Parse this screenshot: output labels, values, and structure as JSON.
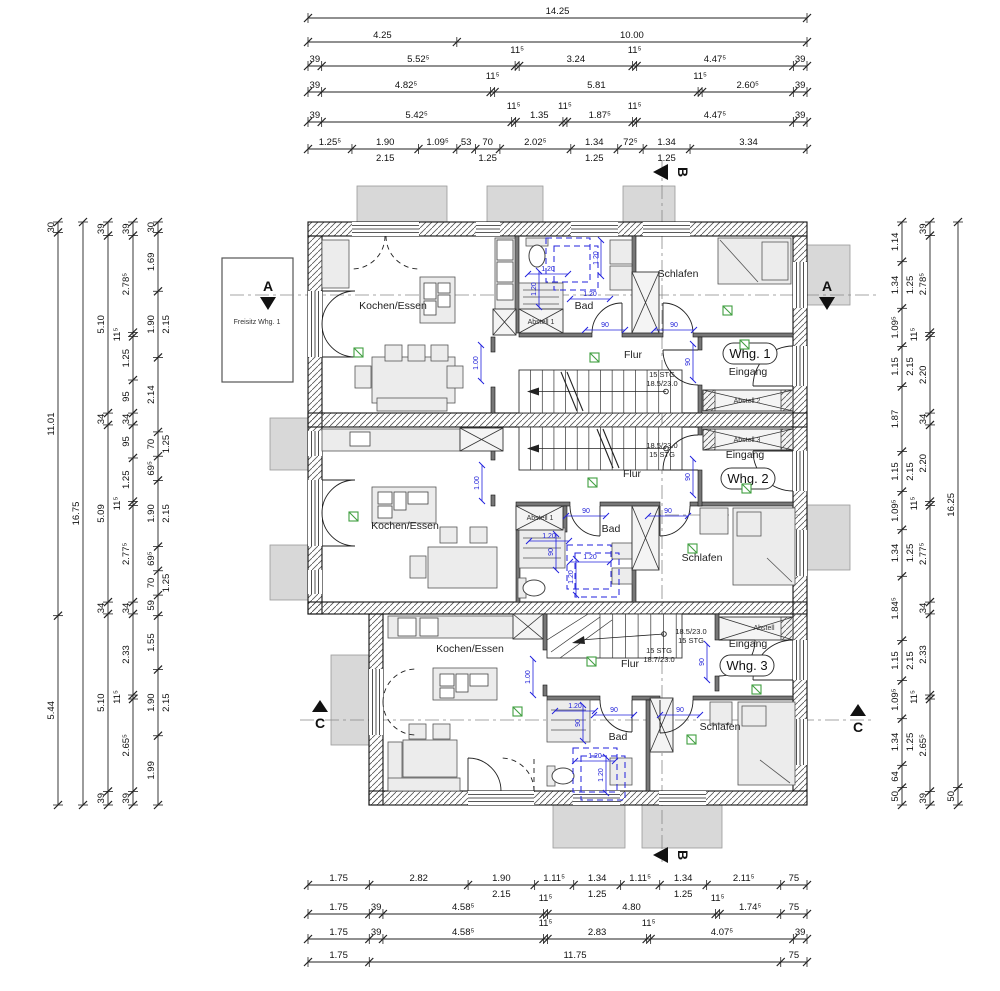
{
  "colors": {
    "line": "#1a1a1a",
    "wall_hatch": "#444444",
    "grey_fill": "#d8d8d8",
    "furniture_fill": "#ececec",
    "sanitary_blue": "#2020dd",
    "detector_green": "#3f9e3f",
    "axis_grey": "#888888"
  },
  "dimensions": {
    "top": [
      {
        "y": 18,
        "segments": [
          [
            14.25,
            "14.25"
          ]
        ]
      },
      {
        "y": 42,
        "segments": [
          [
            4.25,
            "4.25"
          ],
          [
            10.0,
            "10.00"
          ]
        ]
      },
      {
        "y": 66,
        "segments": [
          [
            0.39,
            "39"
          ],
          [
            5.525,
            "5.52⁵"
          ],
          [
            0.115,
            "11⁵"
          ],
          [
            3.24,
            "3.24"
          ],
          [
            0.115,
            "11⁵"
          ],
          [
            4.475,
            "4.47⁵"
          ],
          [
            0.39,
            "39"
          ]
        ]
      },
      {
        "y": 92,
        "segments": [
          [
            0.39,
            "39"
          ],
          [
            4.825,
            "4.82⁵"
          ],
          [
            0.115,
            "11⁵"
          ],
          [
            5.81,
            "5.81"
          ],
          [
            0.115,
            "11⁵"
          ],
          [
            2.605,
            "2.60⁵"
          ],
          [
            0.39,
            "39"
          ]
        ]
      },
      {
        "y": 122,
        "segments": [
          [
            0.39,
            "39"
          ],
          [
            5.425,
            "5.42⁵"
          ],
          [
            0.115,
            "11⁵"
          ],
          [
            1.35,
            "1.35"
          ],
          [
            0.115,
            "11⁵"
          ],
          [
            1.875,
            "1.87⁵"
          ],
          [
            0.115,
            "11⁵"
          ],
          [
            4.475,
            "4.47⁵"
          ],
          [
            0.39,
            "39"
          ]
        ]
      },
      {
        "y": 149,
        "segments": [
          [
            1.255,
            "1.25⁵"
          ],
          [
            1.9,
            "1.90",
            "2.15"
          ],
          [
            1.095,
            "1.09⁵"
          ],
          [
            0.53,
            "53"
          ],
          [
            0.7,
            "70",
            "1.25"
          ],
          [
            2.025,
            "2.02⁵"
          ],
          [
            1.34,
            "1.34",
            "1.25"
          ],
          [
            0.725,
            "72⁵"
          ],
          [
            1.34,
            "1.34",
            "1.25"
          ],
          [
            3.34,
            "3.34"
          ]
        ]
      }
    ],
    "bottom": [
      {
        "y": 885,
        "segments": [
          [
            1.75,
            "1.75"
          ],
          [
            2.82,
            "2.82"
          ],
          [
            1.9,
            "1.90",
            "2.15"
          ],
          [
            1.115,
            "1.11⁵"
          ],
          [
            1.34,
            "1.34",
            "1.25"
          ],
          [
            1.115,
            "1.11⁵"
          ],
          [
            1.34,
            "1.34",
            "1.25"
          ],
          [
            2.115,
            "2.11⁵"
          ],
          [
            0.75,
            "75"
          ]
        ]
      },
      {
        "y": 914,
        "segments": [
          [
            1.75,
            "1.75"
          ],
          [
            0.39,
            "39"
          ],
          [
            4.585,
            "4.58⁵"
          ],
          [
            0.115,
            "11⁵"
          ],
          [
            4.8,
            "4.80"
          ],
          [
            0.115,
            "11⁵"
          ],
          [
            1.745,
            "1.74⁵"
          ],
          [
            0.75,
            "75"
          ]
        ]
      },
      {
        "y": 939,
        "segments": [
          [
            1.75,
            "1.75"
          ],
          [
            0.39,
            "39"
          ],
          [
            4.585,
            "4.58⁵"
          ],
          [
            0.115,
            "11⁵"
          ],
          [
            2.83,
            "2.83"
          ],
          [
            0.115,
            "11⁵"
          ],
          [
            4.075,
            "4.07⁵"
          ],
          [
            0.39,
            "39"
          ]
        ]
      },
      {
        "y": 962,
        "segments": [
          [
            1.75,
            "1.75"
          ],
          [
            11.75,
            "11.75"
          ],
          [
            0.75,
            "75"
          ]
        ]
      }
    ],
    "left": [
      {
        "x": 58,
        "segments": [
          [
            0.3,
            "30"
          ],
          [
            11.01,
            "11.01"
          ],
          [
            5.44,
            "5.44"
          ]
        ]
      },
      {
        "x": 83,
        "segments": [
          [
            16.75,
            "16.75"
          ]
        ]
      },
      {
        "x": 108,
        "segments": [
          [
            0.39,
            "39"
          ],
          [
            5.1,
            "5.10"
          ],
          [
            0.34,
            "34"
          ],
          [
            5.09,
            "5.09"
          ],
          [
            0.34,
            "34"
          ],
          [
            5.1,
            "5.10"
          ],
          [
            0.39,
            "39"
          ]
        ]
      },
      {
        "x": 133,
        "segments": [
          [
            0.39,
            "39"
          ],
          [
            2.785,
            "2.78⁵"
          ],
          [
            0.115,
            "11⁵"
          ],
          [
            1.25,
            "1.25"
          ],
          [
            0.95,
            "95"
          ],
          [
            0.34,
            "34"
          ],
          [
            0.95,
            "95"
          ],
          [
            1.25,
            "1.25"
          ],
          [
            0.115,
            "11⁵"
          ],
          [
            2.775,
            "2.77⁵"
          ],
          [
            0.34,
            "34"
          ],
          [
            2.33,
            "2.33"
          ],
          [
            0.115,
            "11⁵"
          ],
          [
            2.655,
            "2.65⁵"
          ],
          [
            0.39,
            "39"
          ]
        ]
      },
      {
        "x": 158,
        "segments": [
          [
            0.3,
            "30"
          ],
          [
            1.69,
            "1.69"
          ],
          [
            1.9,
            "1.90",
            "2.15"
          ],
          [
            2.14,
            "2.14"
          ],
          [
            0.7,
            "70",
            "1.25"
          ],
          [
            0.695,
            "69⁵"
          ],
          [
            1.9,
            "1.90",
            "2.15"
          ],
          [
            0.695,
            "69⁵"
          ],
          [
            0.7,
            "70",
            "1.25"
          ],
          [
            0.59,
            "59"
          ],
          [
            1.55,
            "1.55"
          ],
          [
            1.9,
            "1.90",
            "2.15"
          ],
          [
            1.99,
            "1.99"
          ]
        ]
      }
    ],
    "right": [
      {
        "x": 902,
        "segments": [
          [
            1.14,
            "1.14"
          ],
          [
            1.34,
            "1.34",
            "1.25"
          ],
          [
            1.095,
            "1.09⁵"
          ],
          [
            1.15,
            "1.15",
            "2.15"
          ],
          [
            1.87,
            "1.87"
          ],
          [
            1.15,
            "1.15",
            "2.15"
          ],
          [
            1.095,
            "1.09⁵"
          ],
          [
            1.34,
            "1.34",
            "1.25"
          ],
          [
            1.845,
            "1.84⁵"
          ],
          [
            1.15,
            "1.15",
            "2.15"
          ],
          [
            1.095,
            "1.09⁵"
          ],
          [
            1.34,
            "1.34",
            "1.25"
          ],
          [
            0.64,
            "64"
          ],
          [
            0.5,
            "50"
          ]
        ]
      },
      {
        "x": 930,
        "segments": [
          [
            0.39,
            "39"
          ],
          [
            2.785,
            "2.78⁵"
          ],
          [
            0.115,
            "11⁵"
          ],
          [
            2.2,
            "2.20"
          ],
          [
            0.34,
            "34"
          ],
          [
            2.2,
            "2.20"
          ],
          [
            0.115,
            "11⁵"
          ],
          [
            2.775,
            "2.77⁵"
          ],
          [
            0.34,
            "34"
          ],
          [
            2.33,
            "2.33"
          ],
          [
            0.115,
            "11⁵"
          ],
          [
            2.655,
            "2.65⁵"
          ],
          [
            0.39,
            "39"
          ]
        ]
      },
      {
        "x": 958,
        "segments": [
          [
            16.25,
            "16.25"
          ],
          [
            0.5,
            "50"
          ]
        ]
      }
    ]
  },
  "plan": {
    "rooms": [
      {
        "t": "Kochen/Essen",
        "x": 393,
        "y": 309
      },
      {
        "t": "Bad",
        "x": 584,
        "y": 309
      },
      {
        "t": "Schlafen",
        "x": 678,
        "y": 277
      },
      {
        "t": "Flur",
        "x": 633,
        "y": 358
      },
      {
        "t": "Eingang",
        "x": 748,
        "y": 375
      },
      {
        "t": "Kochen/Essen",
        "x": 405,
        "y": 529
      },
      {
        "t": "Bad",
        "x": 611,
        "y": 532
      },
      {
        "t": "Schlafen",
        "x": 702,
        "y": 561
      },
      {
        "t": "Flur",
        "x": 632,
        "y": 477
      },
      {
        "t": "Eingang",
        "x": 745,
        "y": 458
      },
      {
        "t": "Kochen/Essen",
        "x": 470,
        "y": 652
      },
      {
        "t": "Bad",
        "x": 618,
        "y": 740
      },
      {
        "t": "Schlafen",
        "x": 720,
        "y": 730
      },
      {
        "t": "Flur",
        "x": 630,
        "y": 667
      },
      {
        "t": "Eingang",
        "x": 748,
        "y": 647
      }
    ],
    "small_labels": [
      {
        "t": "Abstell 1",
        "x": 541,
        "y": 324
      },
      {
        "t": "Abstell 2",
        "x": 747,
        "y": 403
      },
      {
        "t": "Abstell 3",
        "x": 747,
        "y": 442
      },
      {
        "t": "Abstell 1",
        "x": 540,
        "y": 520
      },
      {
        "t": "Abstell",
        "x": 764,
        "y": 630
      },
      {
        "t": "Freisitz Whg. 1",
        "x": 257,
        "y": 324
      }
    ],
    "apartment_badges": [
      {
        "t": "Whg. 1",
        "x": 750,
        "y": 354
      },
      {
        "t": "Whg. 2",
        "x": 748,
        "y": 479
      },
      {
        "t": "Whg. 3",
        "x": 747,
        "y": 666
      }
    ],
    "stair_notes": [
      {
        "l1": "15 STG",
        "l2": "18.5/23.0",
        "x": 662,
        "y": 377
      },
      {
        "l1": "18.5/23.0",
        "l2": "15 STG",
        "x": 662,
        "y": 448
      },
      {
        "l1": "18.5/23.0",
        "l2": "15 STG",
        "x": 691,
        "y": 634
      },
      {
        "l1": "15 STG",
        "l2": "18.7/23.0",
        "x": 659,
        "y": 653
      }
    ],
    "blue_dims": [
      [
        "1.20",
        598,
        258,
        1
      ],
      [
        "1.20",
        548,
        271,
        0
      ],
      [
        "1.20",
        536,
        289,
        1
      ],
      [
        "1.20",
        590,
        296,
        0
      ],
      [
        "90",
        605,
        327,
        0
      ],
      [
        "90",
        674,
        327,
        0
      ],
      [
        "90",
        690,
        362,
        1
      ],
      [
        "1.00",
        478,
        363,
        1
      ],
      [
        "1.20",
        549,
        538,
        0
      ],
      [
        "90",
        553,
        552,
        1
      ],
      [
        "1.20",
        590,
        559,
        0
      ],
      [
        "1.20",
        573,
        577,
        1
      ],
      [
        "90",
        586,
        513,
        0
      ],
      [
        "90",
        668,
        513,
        0
      ],
      [
        "90",
        690,
        477,
        1
      ],
      [
        "1.00",
        479,
        483,
        1
      ],
      [
        "1.20",
        575,
        708,
        0
      ],
      [
        "90",
        580,
        723,
        1
      ],
      [
        "1.20",
        595,
        758,
        0
      ],
      [
        "1.20",
        603,
        775,
        1
      ],
      [
        "90",
        614,
        712,
        0
      ],
      [
        "90",
        680,
        712,
        0
      ],
      [
        "90",
        704,
        662,
        1
      ],
      [
        "1.00",
        530,
        677,
        1
      ]
    ],
    "smoke_detectors": [
      [
        358,
        352
      ],
      [
        594,
        357
      ],
      [
        727,
        310
      ],
      [
        744,
        344
      ],
      [
        353,
        516
      ],
      [
        592,
        482
      ],
      [
        692,
        548
      ],
      [
        746,
        488
      ],
      [
        517,
        711
      ],
      [
        591,
        661
      ],
      [
        756,
        689
      ],
      [
        691,
        739
      ]
    ],
    "section_markers": [
      {
        "t": "A",
        "x": 268,
        "y": 297,
        "type": "down"
      },
      {
        "t": "A",
        "x": 827,
        "y": 297,
        "type": "down"
      },
      {
        "t": "B",
        "x": 661,
        "y": 172,
        "type": "left"
      },
      {
        "t": "B",
        "x": 661,
        "y": 855,
        "type": "left"
      },
      {
        "t": "C",
        "x": 320,
        "y": 700,
        "type": "up"
      },
      {
        "t": "C",
        "x": 858,
        "y": 704,
        "type": "up"
      }
    ]
  }
}
